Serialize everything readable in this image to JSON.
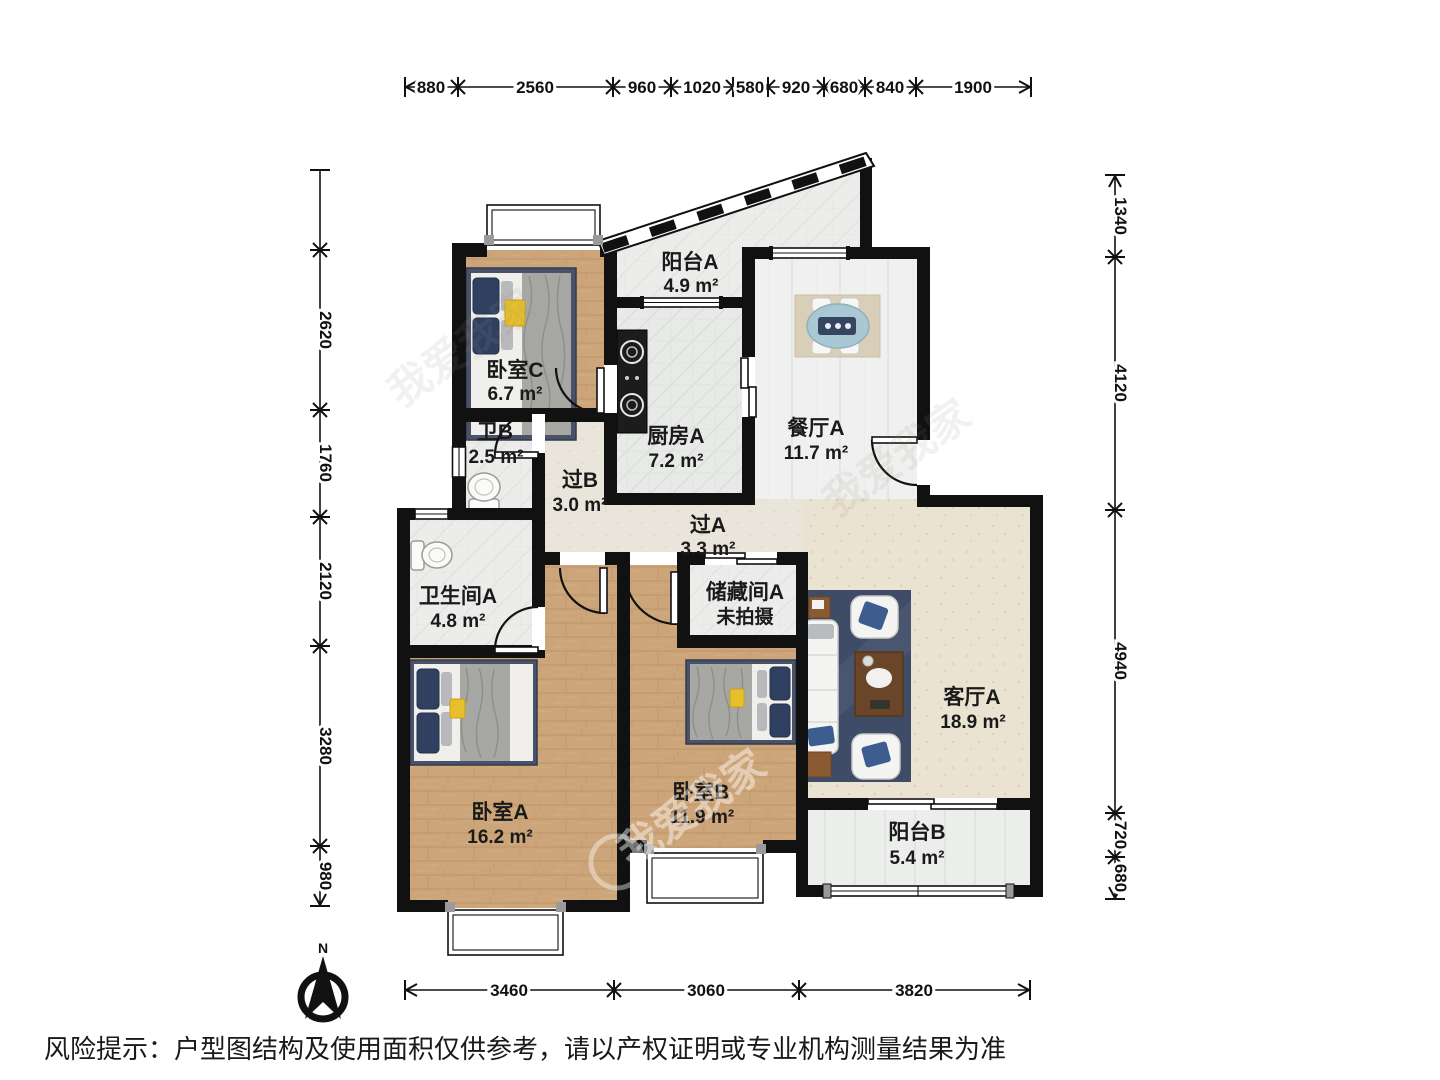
{
  "plan": {
    "watermark": "我爱我家",
    "compass": {
      "north_label": "N"
    },
    "rooms": [
      {
        "name": "阳台A",
        "area": "4.9 m²"
      },
      {
        "name": "卧室C",
        "area": "6.7 m²"
      },
      {
        "name": "厨房A",
        "area": "7.2 m²"
      },
      {
        "name": "餐厅A",
        "area": "11.7 m²"
      },
      {
        "name": "卫B",
        "area": "2.5 m²"
      },
      {
        "name": "过B",
        "area": "3.0 m²"
      },
      {
        "name": "过A",
        "area": "3.3 m²"
      },
      {
        "name": "卫生间A",
        "area": "4.8 m²"
      },
      {
        "name": "储藏间A",
        "area": "未拍摄"
      },
      {
        "name": "客厅A",
        "area": "18.9 m²"
      },
      {
        "name": "卧室A",
        "area": "16.2 m²"
      },
      {
        "name": "卧室B",
        "area": "11.9 m²"
      },
      {
        "name": "阳台B",
        "area": "5.4 m²"
      }
    ],
    "dimensions": {
      "top": [
        "880",
        "2560",
        "960",
        "1020",
        "580",
        "920",
        "680",
        "840",
        "1900"
      ],
      "bottom": [
        "3460",
        "3060",
        "3820"
      ],
      "left": [
        "2620",
        "1760",
        "2120",
        "3280",
        "980"
      ],
      "right": [
        "1340",
        "4120",
        "4940",
        "720",
        "680"
      ]
    }
  },
  "footer": {
    "disclaimer": "风险提示：户型图结构及使用面积仅供参考，请以产权证明或专业机构测量结果为准"
  }
}
